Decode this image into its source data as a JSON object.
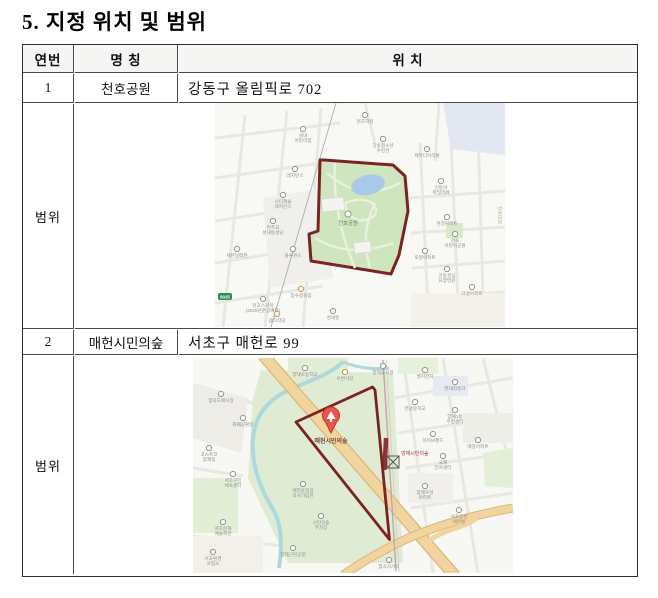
{
  "page": {
    "title": "5. 지정 위치 및 범위"
  },
  "table": {
    "headers": {
      "no": "연번",
      "name": "명 칭",
      "location": "위 치"
    },
    "rows": [
      {
        "no": "1",
        "name": "천호공원",
        "location": "강동구 올림픽로 702",
        "range_label": "범위"
      },
      {
        "no": "2",
        "name": "매헌시민의숲",
        "location": "서초구 매헌로 99",
        "range_label": "범위"
      }
    ]
  },
  "colors": {
    "boundary": "#7b2222",
    "park_fill": "#cfe5bd",
    "pond_fill": "#a9c9ea",
    "stream": "#abd9dc",
    "highway": "#f2d49e",
    "marker_red": "#e8574a",
    "table_border": "#2f2f2f"
  },
  "maps": [
    {
      "name": "cheonho-park-map",
      "park_label": "천호공원",
      "road_label": "천호대로",
      "pois": [
        {
          "x": 88,
          "y": 26,
          "lines": [
            "성내",
            "어린이집"
          ]
        },
        {
          "x": 150,
          "y": 12,
          "lines": [
            "천호학원"
          ]
        },
        {
          "x": 168,
          "y": 36,
          "lines": [
            "강동청소년",
            "수련관"
          ]
        },
        {
          "x": 80,
          "y": 66,
          "lines": [
            "레지던스"
          ]
        },
        {
          "x": 68,
          "y": 92,
          "lines": [
            "시티캐슬",
            "레지던스"
          ]
        },
        {
          "x": 58,
          "y": 118,
          "lines": [
            "천주교",
            "성내동성당"
          ]
        },
        {
          "x": 78,
          "y": 146,
          "lines": [
            "블루윈스"
          ]
        },
        {
          "x": 22,
          "y": 146,
          "lines": [
            "세븐일레븐"
          ]
        },
        {
          "x": 86,
          "y": 186,
          "lines": [
            "장수정육점"
          ],
          "accent": "#cf9a55"
        },
        {
          "x": 48,
          "y": 196,
          "lines": [
            "천호스카이",
            "(2025년준공예정)"
          ]
        },
        {
          "x": 62,
          "y": 211,
          "lines": [
            "삼미식당"
          ],
          "accent": "#cf9a55"
        },
        {
          "x": 10,
          "y": 194,
          "lines": [
            "6025"
          ],
          "badge": true
        },
        {
          "x": 118,
          "y": 208,
          "lines": [
            "성내동"
          ]
        },
        {
          "x": 212,
          "y": 46,
          "lines": [
            "제이디어리빌"
          ]
        },
        {
          "x": 226,
          "y": 78,
          "lines": [
            "신동아",
            "파밀리에"
          ]
        },
        {
          "x": 232,
          "y": 114,
          "lines": [
            "천일아파트"
          ]
        },
        {
          "x": 210,
          "y": 148,
          "lines": [
            "로얄아파트"
          ]
        },
        {
          "x": 232,
          "y": 166,
          "lines": [
            "강동성심",
            "요양병원"
          ]
        },
        {
          "x": 240,
          "y": 131,
          "lines": [
            "천호",
            "어린이공원"
          ]
        },
        {
          "x": 257,
          "y": 184,
          "lines": [
            "다성아파트"
          ]
        }
      ]
    },
    {
      "name": "maeheon-citizens-forest-map",
      "park_label": "매헌시민의숲",
      "station_label": "양재시민의숲",
      "pois": [
        {
          "x": 28,
          "y": 36,
          "lines": [
            "양곡도매시장"
          ]
        },
        {
          "x": 50,
          "y": 60,
          "lines": [
            "화훼공판장"
          ]
        },
        {
          "x": 16,
          "y": 90,
          "lines": [
            "코스트코",
            "양재점"
          ]
        },
        {
          "x": 40,
          "y": 116,
          "lines": [
            "서초구민",
            "체육센터"
          ]
        },
        {
          "x": 30,
          "y": 164,
          "lines": [
            "서초문화",
            "예술회관"
          ]
        },
        {
          "x": 20,
          "y": 194,
          "lines": [
            "서초환경",
            "사업소"
          ]
        },
        {
          "x": 112,
          "y": 10,
          "lines": [
            "양재초등학교"
          ]
        },
        {
          "x": 152,
          "y": 14,
          "lines": [
            "우면식당"
          ],
          "accent": "#cf9a55"
        },
        {
          "x": 190,
          "y": 8,
          "lines": [
            "양재꽃시장"
          ]
        },
        {
          "x": 110,
          "y": 126,
          "lines": [
            "매헌윤봉길",
            "의사기념관"
          ]
        },
        {
          "x": 128,
          "y": 158,
          "lines": [
            "시민의숲",
            "주차장"
          ]
        },
        {
          "x": 100,
          "y": 190,
          "lines": [
            "양재근린공원"
          ]
        },
        {
          "x": 232,
          "y": 12,
          "lines": [
            "엘지전자"
          ]
        },
        {
          "x": 262,
          "y": 24,
          "lines": [
            "현대자동차"
          ]
        },
        {
          "x": 222,
          "y": 44,
          "lines": [
            "언남중학교"
          ]
        },
        {
          "x": 262,
          "y": 52,
          "lines": [
            "양재1동",
            "주민센터"
          ]
        },
        {
          "x": 240,
          "y": 76,
          "lines": [
            "하이브랜드"
          ]
        },
        {
          "x": 285,
          "y": 82,
          "lines": [
            "매봉아파트"
          ]
        },
        {
          "x": 250,
          "y": 98,
          "lines": [
            "국제",
            "전자센터"
          ]
        },
        {
          "x": 232,
          "y": 128,
          "lines": [
            "양재우성",
            "아파트"
          ]
        },
        {
          "x": 266,
          "y": 152,
          "lines": [
            "서초삼성",
            "쉐르빌"
          ]
        },
        {
          "x": 196,
          "y": 202,
          "lines": [
            "염곡사거리"
          ]
        }
      ]
    }
  ]
}
